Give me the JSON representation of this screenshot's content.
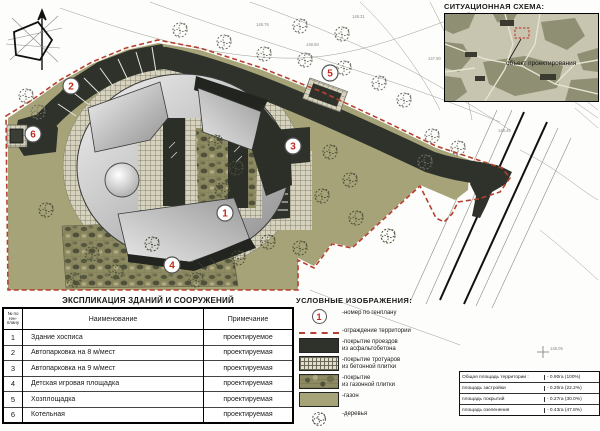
{
  "explication": {
    "title": "ЭКСПЛИКАЦИЯ ЗДАНИЙ И СООРУЖЕНИЙ",
    "col_num": "№ по ген-плану",
    "col_name": "Наименование",
    "col_note": "Примечание",
    "rows": [
      {
        "num": "1",
        "name": "Здание хосписа",
        "note": "проектируемое"
      },
      {
        "num": "2",
        "name": "Автопарковка на 8 м/мест",
        "note": "проектируемая"
      },
      {
        "num": "3",
        "name": "Автопарковка на 9 м/мест",
        "note": "проектируемая"
      },
      {
        "num": "4",
        "name": "Детская игровая площадка",
        "note": "проектируемая"
      },
      {
        "num": "5",
        "name": "Хозплощадка",
        "note": "проектируемая"
      },
      {
        "num": "6",
        "name": "Котельная",
        "note": "проектируемая"
      }
    ]
  },
  "legend": {
    "title": "УСЛОВНЫЕ  ИЗОБРАЖЕНИЯ:",
    "sample_number": "1",
    "items": [
      {
        "symbol": "number-circle",
        "label": "-номер по генплану",
        "label2": ""
      },
      {
        "symbol": "red-dashed-line",
        "label": "-ограждение территории",
        "label2": ""
      },
      {
        "symbol": "asphalt-swatch",
        "label": "-покрытие проездов",
        "label2": "из асфальтобетона"
      },
      {
        "symbol": "concrete-tile-swatch",
        "label": "-покрытие тротуаров",
        "label2": "из бетонной плитки"
      },
      {
        "symbol": "lawn-tile-swatch",
        "label": "-покрытие",
        "label2": "из газонной плитки"
      },
      {
        "symbol": "lawn-swatch",
        "label": "-газон",
        "label2": ""
      },
      {
        "symbol": "tree-symbol",
        "label": "-деревья",
        "label2": ""
      }
    ]
  },
  "situation": {
    "title": "СИТУАЦИОННАЯ СХЕМА:",
    "object_label": "объект проектирования"
  },
  "areas": {
    "rows": [
      {
        "label": "Общая площадь территории :",
        "value": "- 0.90га (100%)"
      },
      {
        "label": "площадь застройки",
        "value": "- 0.20га (22.2%)"
      },
      {
        "label": "площадь покрытий",
        "value": "- 0.27га (30.0%)"
      },
      {
        "label": "площадь озеленения",
        "value": "- 0.43га (47.8%)"
      }
    ]
  },
  "plan": {
    "markers": [
      "1",
      "2",
      "3",
      "4",
      "5",
      "6"
    ],
    "topo_labels": [
      "148.76",
      "148.50",
      "148.31",
      "147.90",
      "148.45",
      "148.05"
    ],
    "colors": {
      "lawn": "#a6a378",
      "asphalt": "#2e322a",
      "boundary_red": "#b5402f",
      "marker_number_red": "#c22a1e"
    }
  }
}
